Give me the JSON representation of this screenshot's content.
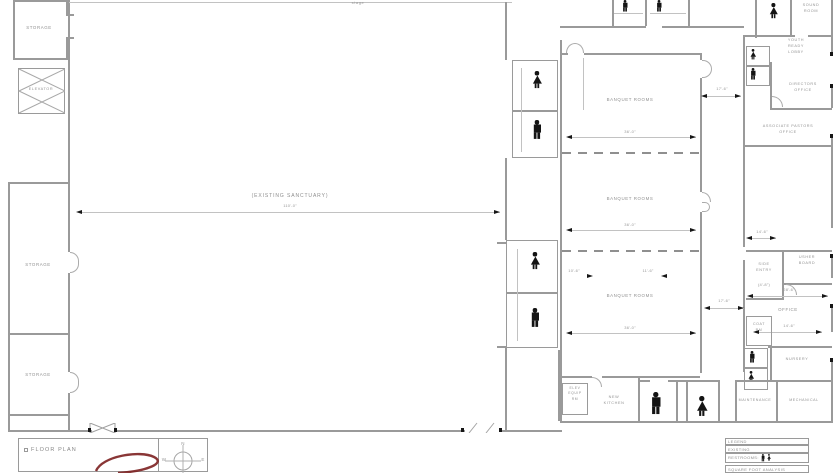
{
  "colors": {
    "wall": "#9a9a9a",
    "ink": "#141414",
    "text": "#929292",
    "annotation_red": "#7c2020"
  },
  "title_block": {
    "title": "FLOOR PLAN",
    "compass_n": "N",
    "compass_w": "W",
    "compass_e": "E"
  },
  "legend": {
    "row1": "LEGEND",
    "row2": "EXISTING",
    "row3": "RESTROOMS:",
    "footer": "SQUARE FOOT ANALYSIS"
  },
  "big_room": {
    "label": "(EXISTING SANCTUARY)",
    "sub": "110'-0\"",
    "note": "stage"
  },
  "left_wing": {
    "storage_top": "STORAGE",
    "elevator": "ELEVATOR",
    "storage_mid": "STORAGE",
    "storage_low": "STORAGE"
  },
  "classrooms": {
    "r1": "BANQUET ROOMS",
    "r2": "BANQUET ROOMS",
    "r3": "BANQUET ROOMS",
    "d1": "36'-0\"",
    "d2": "36'-0\"",
    "d3": "36'-0\"",
    "dl": "10'-6\"",
    "dr": "11'-6\""
  },
  "corridor": {
    "d1": "17'-6\"",
    "d2": "17'-6\""
  },
  "right_wing": {
    "sound": "SOUND\nROOM",
    "lobby": "YOUTH\nREADY\nLOBBY",
    "directors": "DIRECTORS\nOFFICE",
    "assoc": "ASSOCIATE PASTORS\nOFFICE",
    "d146": "14'-6\"",
    "entry": "SIDE\nENTRY",
    "entry_dim": "(4'-8\")",
    "usher": "USHER\nBOARD",
    "office": "OFFICE",
    "d286": "28'-6\"",
    "d146b": "14'-6\"",
    "coat": "COAT\nRM",
    "nursery": "NURSERY"
  },
  "bottom_strip": {
    "elev": "ELEV\nEQUIP\nRM",
    "kitchen": "NEW\nKITCHEN",
    "maintenance": "MAINTENANCE",
    "mechanical": "MECHANICAL"
  },
  "icons": {
    "man": "man-restroom-icon",
    "woman": "woman-restroom-icon",
    "compass": "compass-icon",
    "cloud": "red-markup-scribble"
  }
}
